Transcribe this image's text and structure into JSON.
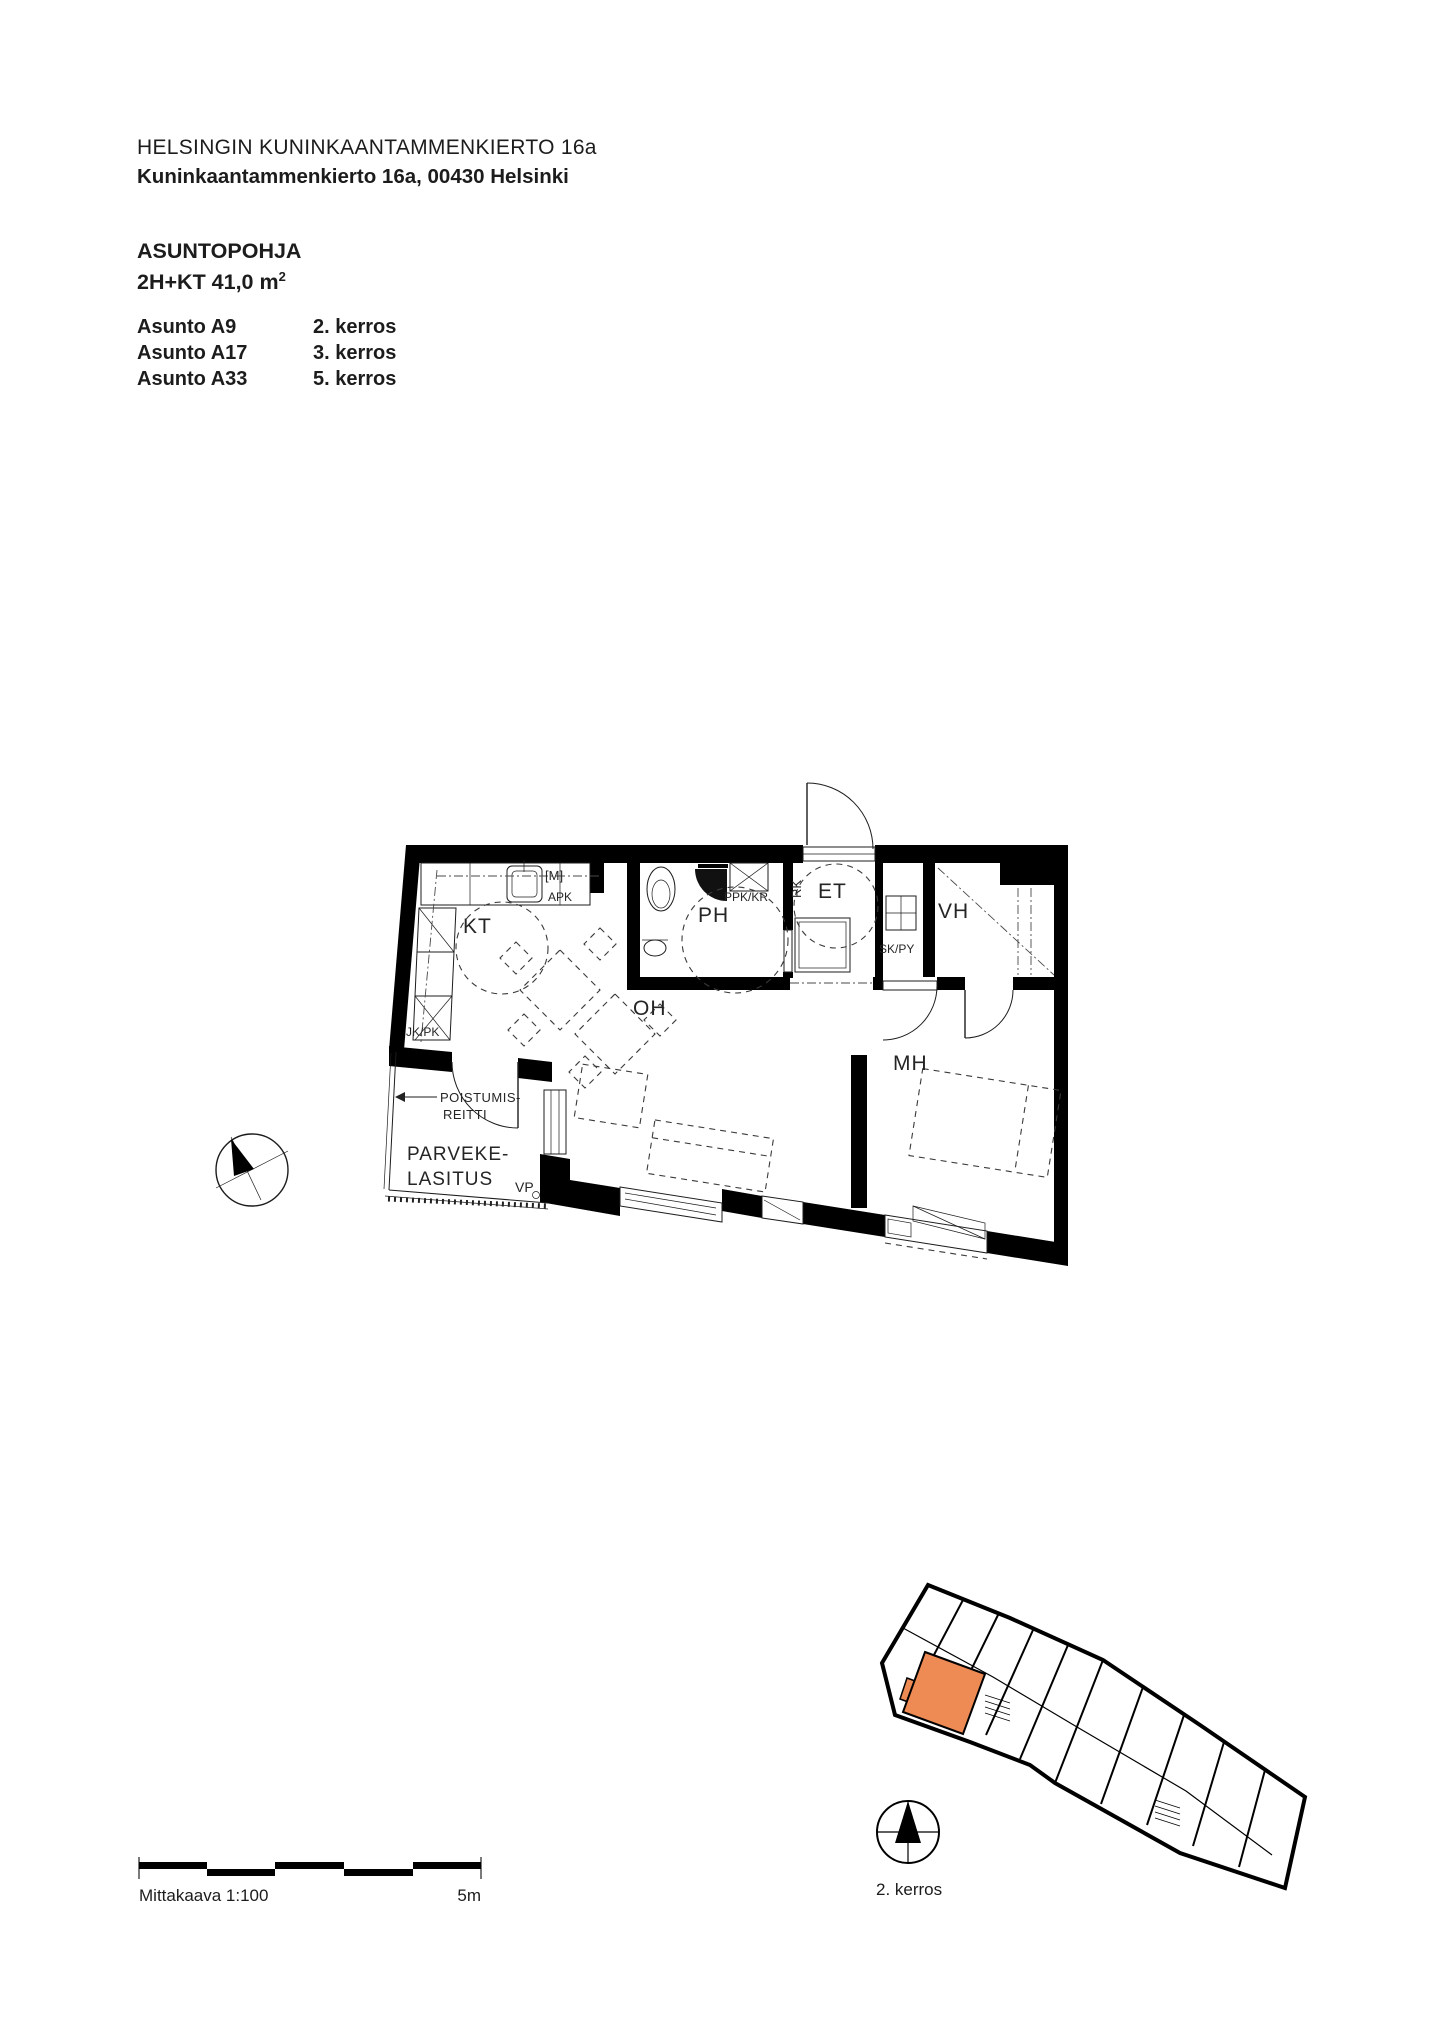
{
  "header": {
    "line1": "HELSINGIN KUNINKAANTAMMENKIERTO 16a",
    "line2": "Kuninkaantammenkierto 16a, 00430 Helsinki"
  },
  "plan_info": {
    "type_label": "ASUNTOPOHJA",
    "size_label": "2H+KT 41,0 m",
    "size_superscript": "2"
  },
  "apartments": [
    {
      "name": "Asunto A9",
      "floor": "2. kerros"
    },
    {
      "name": "Asunto A17",
      "floor": "3. kerros"
    },
    {
      "name": "Asunto A33",
      "floor": "5. kerros"
    }
  ],
  "floor_plan": {
    "labels": {
      "kt": "KT",
      "ph": "PH",
      "et": "ET",
      "vh": "VH",
      "oh": "OH",
      "mh": "MH",
      "m": "[M]",
      "apk": "APK",
      "ppk_kr": "PPK/KR",
      "rk": "RK",
      "sk_py": "SK/PY",
      "jk_pk": "JK/PK",
      "vp": "VP",
      "exit_route_line1": "POISTUMIS-",
      "exit_route_line2": "REITTI",
      "balcony_glazing_line1": "PARVEKE-",
      "balcony_glazing_line2": "LASITUS"
    }
  },
  "key_plan": {
    "floor_label": "2. kerros",
    "highlight_color": "#EE8B55"
  },
  "scale_bar": {
    "label": "Mittakaava 1:100",
    "max_label": "5m"
  }
}
